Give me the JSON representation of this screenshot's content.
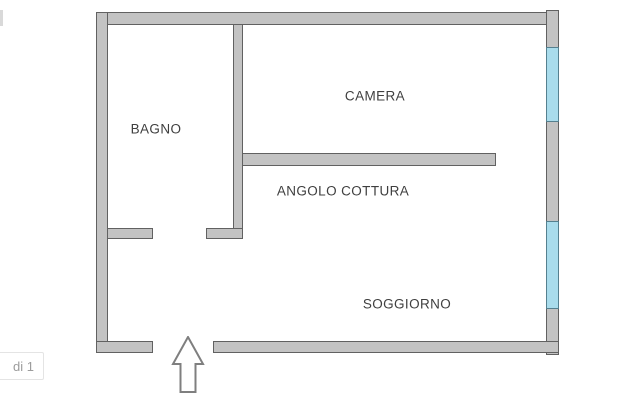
{
  "pagination": {
    "label": "di 1"
  },
  "floorplan": {
    "colors": {
      "wall_fill": "#c3c3c3",
      "wall_border": "#616161",
      "window_fill": "#a9dcec",
      "window_border": "#55808f",
      "label_color": "#3f3f3f",
      "arrow_outline": "#7f7f7f"
    },
    "rooms": [
      {
        "name": "bagno",
        "label": "BAGNO",
        "x": 156,
        "y": 129
      },
      {
        "name": "camera",
        "label": "CAMERA",
        "x": 375,
        "y": 96
      },
      {
        "name": "angolo-cottura",
        "label": "ANGOLO COTTURA",
        "x": 343,
        "y": 191
      },
      {
        "name": "soggiorno",
        "label": "SOGGIORNO",
        "x": 407,
        "y": 304
      }
    ],
    "walls": [
      {
        "name": "outer-wall-top",
        "x": 96,
        "y": 12,
        "w": 462,
        "h": 13
      },
      {
        "name": "outer-wall-left",
        "x": 96,
        "y": 12,
        "w": 12,
        "h": 341
      },
      {
        "name": "outer-wall-right",
        "x": 546,
        "y": 10,
        "w": 13,
        "h": 345
      },
      {
        "name": "outer-wall-bottom-left",
        "x": 96,
        "y": 341,
        "w": 57,
        "h": 12
      },
      {
        "name": "outer-wall-bottom-right",
        "x": 213,
        "y": 341,
        "w": 346,
        "h": 12
      },
      {
        "name": "bagno-east-wall",
        "x": 233,
        "y": 24,
        "w": 10,
        "h": 215
      },
      {
        "name": "bagno-door-jamb",
        "x": 206,
        "y": 228,
        "w": 37,
        "h": 11
      },
      {
        "name": "bagno-south-stub",
        "x": 107,
        "y": 228,
        "w": 46,
        "h": 11
      },
      {
        "name": "cottura-divider-wall",
        "x": 242,
        "y": 153,
        "w": 254,
        "h": 13
      }
    ],
    "windows": [
      {
        "name": "window-1",
        "x": 546,
        "y": 47,
        "w": 13,
        "h": 75
      },
      {
        "name": "window-2",
        "x": 546,
        "y": 221,
        "w": 13,
        "h": 88
      }
    ]
  }
}
